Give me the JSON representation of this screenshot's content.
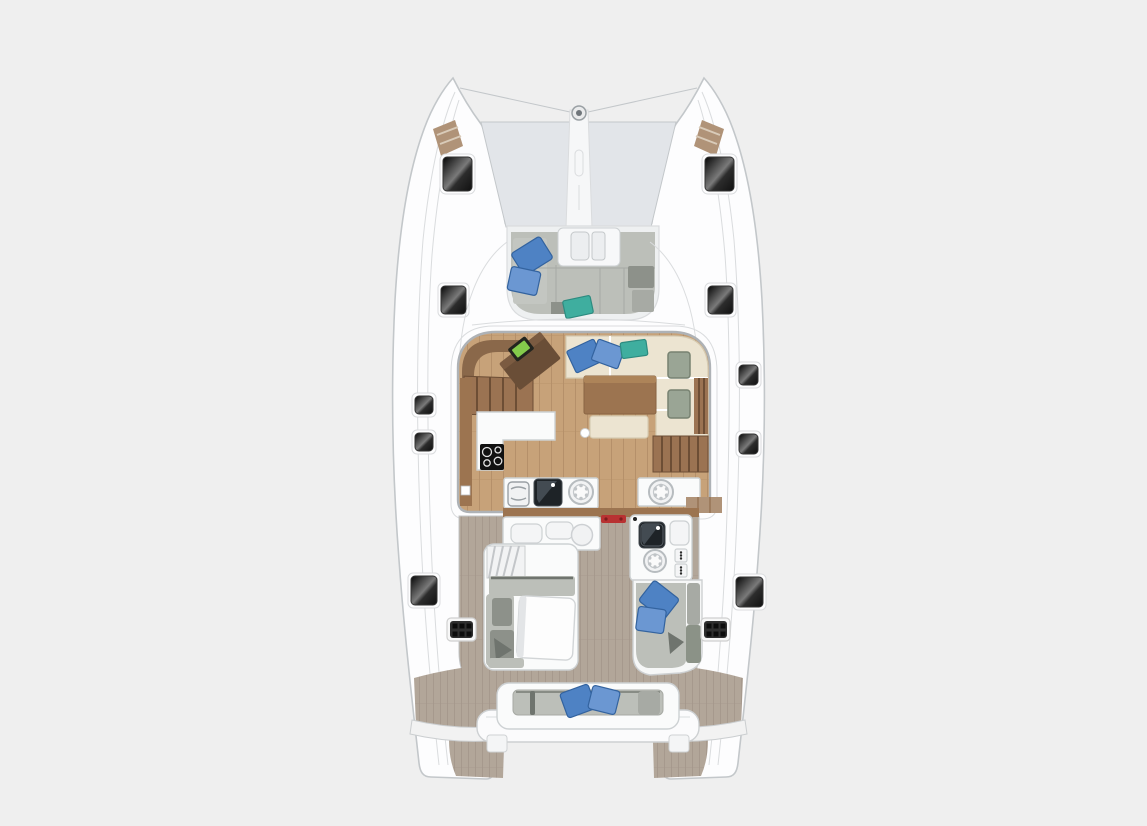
{
  "illustration": {
    "subject": "catamaran-deck-floor-plan",
    "view": "top-down",
    "canvas": {
      "width": 1147,
      "height": 826
    }
  },
  "colors": {
    "background": "#efefef",
    "hull_white": "#fdfdfe",
    "outline_gray": "#c3c7ca",
    "outline_light": "#dadcde",
    "trampoline": "#e2e5e9",
    "bowsprit_white": "#f6f7f8",
    "hatch_frame": "#333333",
    "bow_deck_tan": "#b09378",
    "wood_floor": "#c7a279",
    "wood_plank_line": "#b5906a",
    "salon_wall": "#aeb2b6",
    "teak_deck": "#b2a699",
    "teak_plank_line": "#a3968a",
    "counter_white": "#fafbfb",
    "counter_edge": "#cdd1d3",
    "seat_gray": "#bcbfb9",
    "seat_gray_mid": "#a7aaa4",
    "seat_gray_dark": "#8d918a",
    "seat_shadow": "#6f746e",
    "cushion_cream": "#ece4d1",
    "cushion_cream_edge": "#d6cbb2",
    "pillow_blue": "#4e82c4",
    "pillow_blue_light": "#6b97d2",
    "pillow_blue_edge": "#33639f",
    "pillow_teal": "#3fae9f",
    "pillow_teal_edge": "#2d8b80",
    "headrest_sage": "#9aa595",
    "headrest_sage_edge": "#778271",
    "table_wood": "#9c7450",
    "table_wood_light": "#ad8459",
    "chart_table_brown": "#6a4e37",
    "chart_table_light": "#7b5b41",
    "device_green": "#84cb4b",
    "device_frame": "#23251f",
    "stairs_brown": "#9b7352",
    "stairs_riser": "#6d4e35",
    "cabinet_brown": "#8a684a",
    "stove_black": "#111111",
    "sink_black": "#1e2327",
    "sink_sheen": "#434b52",
    "accent_red": "#b83232",
    "vent_dark": "#2f2f2f",
    "vent_dot": "#0c0c0c"
  },
  "legend": {
    "bow": [
      "port-hull-tip",
      "starboard-hull-tip",
      "trampoline",
      "anchor-channel",
      "foredeck-hatches",
      "bow-deck-pads"
    ],
    "forward_cockpit": [
      "u-shaped-lounge",
      "blue-pillows",
      "teal-pillow",
      "windlass-hatch"
    ],
    "salon": [
      "chart-table",
      "navigation-device",
      "port-stairs",
      "l-shaped-sofa",
      "blue-pillows",
      "teal-pillow",
      "headrests",
      "dining-table",
      "ottoman",
      "galley-counter",
      "stove",
      "sink",
      "round-deck-hatches",
      "starboard-stairs",
      "sliding-door"
    ],
    "aft_cockpit": [
      "wet-bar",
      "side-steps",
      "port-lounge",
      "cockpit-table",
      "grill-module",
      "starboard-seat",
      "blue-pillows",
      "deck-vents",
      "side-deck-hatches"
    ],
    "stern": [
      "aft-bench",
      "blue-pillows",
      "transom-beam",
      "port-swim-platform",
      "starboard-swim-platform"
    ]
  }
}
